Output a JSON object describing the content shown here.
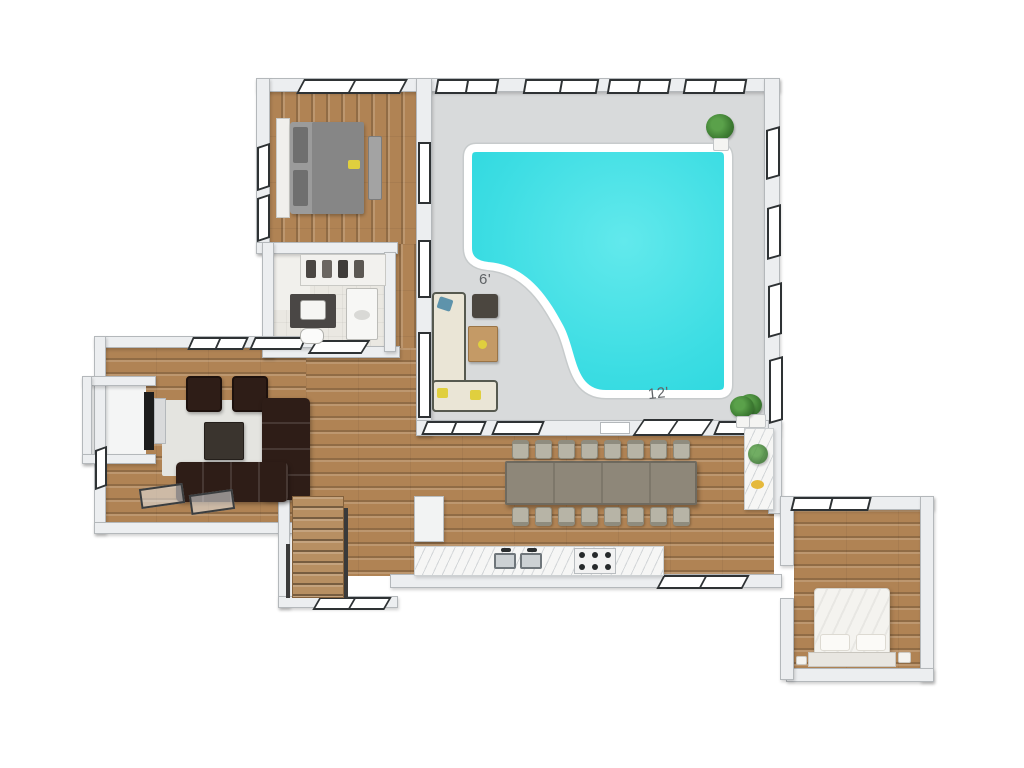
{
  "annotations": {
    "pool_width_label": "6'",
    "pool_length_label": "12'"
  },
  "palette": {
    "background": "#ffffff",
    "wall": "#eceef0",
    "wall_edge": "#b4b8bb",
    "floor_tile": "#d8dadb",
    "wood": "#b08354",
    "pool_water": "#2fd8df",
    "pool_water_light": "#62e9ec",
    "pool_coping": "#ffffff",
    "sofa_dark": "#2e1d17",
    "rug": "#e4e4e0",
    "lounge_sofa": "#eae5d6",
    "dining_table": "#8e8779",
    "chair": "#b7b4a6",
    "counter": "#f7f8f8",
    "frame_dark": "#2e3234",
    "plant": "#3e7d33",
    "marble": "#f6f6f5",
    "label_text": "#5f6366",
    "accent_yellow": "#e0cf3e",
    "accent_teal": "#5e93ab"
  }
}
